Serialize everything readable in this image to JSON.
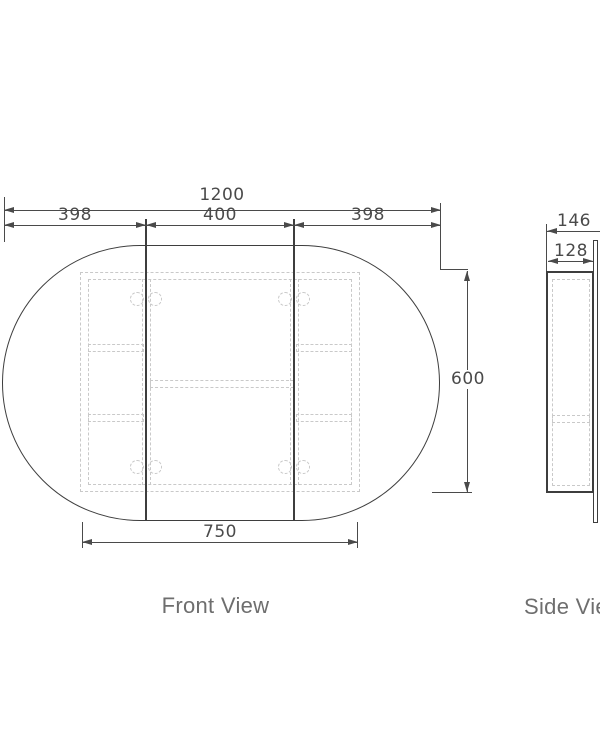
{
  "drawing": {
    "front_view": {
      "label": "Front View",
      "dim_overall_width": "1200",
      "dim_left_section": "398",
      "dim_middle_section": "400",
      "dim_right_section": "398",
      "dim_height": "600",
      "dim_carcass_width": "750"
    },
    "side_view": {
      "label": "Side View",
      "dim_overall_depth": "146",
      "dim_carcass_depth": "128"
    },
    "colors": {
      "outline": "#3e3e3e",
      "dimension_line": "#4a4a4a",
      "hidden_line": "#c9c9c9",
      "label_text": "#6e6e6e",
      "background": "#ffffff"
    }
  }
}
